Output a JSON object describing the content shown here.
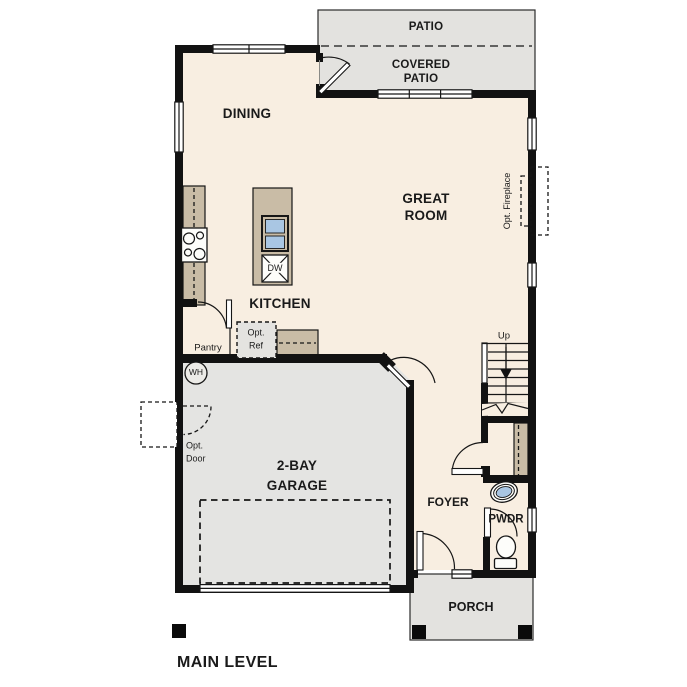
{
  "plan": {
    "title": "MAIN LEVEL",
    "colors": {
      "interior": "#f8eee1",
      "outdoor": "#e3e2df",
      "garage": "#e4e4e2",
      "counter": "#c9bca6",
      "fixture_blue": "#a9c6e3",
      "wall": "#121212",
      "label": "#1a1a1a"
    },
    "rooms": {
      "patio": {
        "label": "PATIO"
      },
      "covered_patio": {
        "label": "COVERED\nPATIO"
      },
      "dining": {
        "label": "DINING"
      },
      "great_room": {
        "label": "GREAT\nROOM"
      },
      "kitchen": {
        "label": "KITCHEN"
      },
      "garage": {
        "label": "2-BAY\nGARAGE"
      },
      "foyer": {
        "label": "FOYER"
      },
      "powder": {
        "label": "PWDR"
      },
      "porch": {
        "label": "PORCH"
      }
    },
    "features": {
      "pantry": {
        "label": "Pantry"
      },
      "opt_ref": {
        "label": "Opt.\nRef"
      },
      "opt_fireplace": {
        "label": "Opt. Fireplace"
      },
      "opt_door": {
        "label": "Opt.\nDoor"
      },
      "dishwasher": {
        "label": "DW"
      },
      "water_heater": {
        "label": "WH"
      },
      "stairs_up": {
        "label": "Up"
      }
    }
  }
}
